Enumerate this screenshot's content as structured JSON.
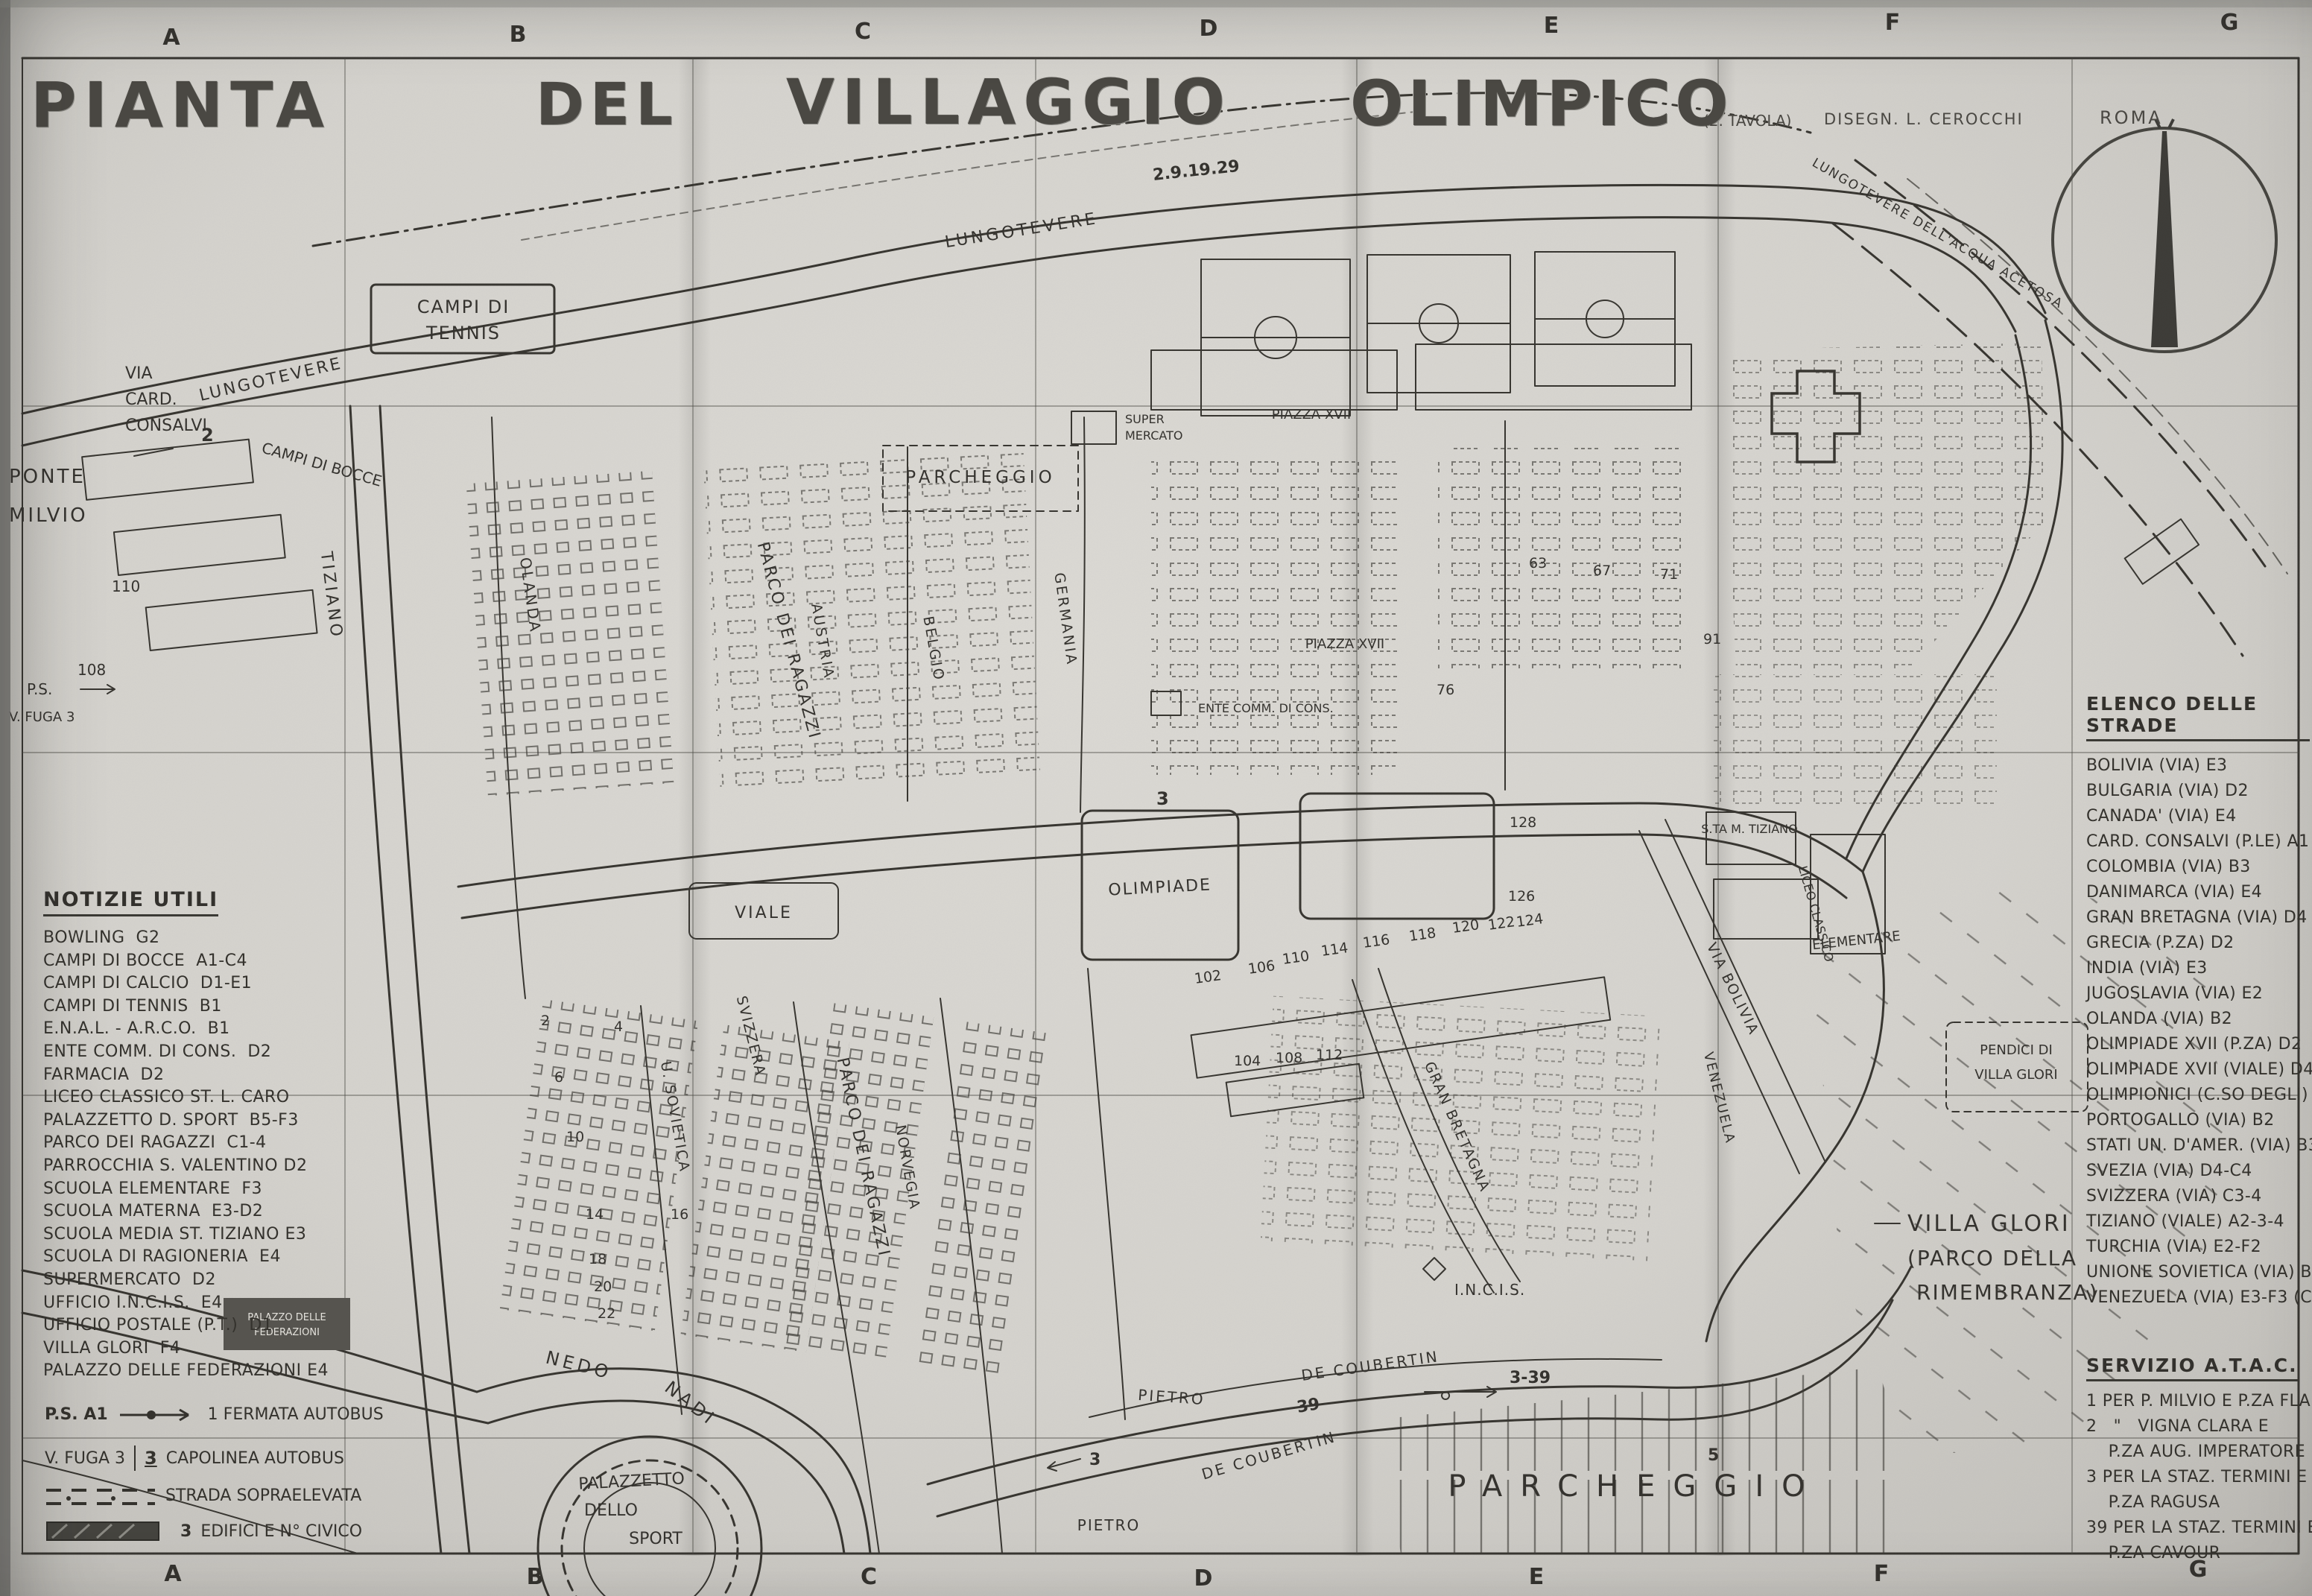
{
  "title": {
    "pianta": "PIANTA",
    "del": "DEL",
    "villaggio": "VILLAGGIO",
    "olimpico": "OLIMPICO",
    "note": "(2. TAVOLA)",
    "credit": "DISEGN. L. CEROCCHI",
    "city": "ROMA"
  },
  "grid": {
    "top": [
      "A",
      "B",
      "C",
      "D",
      "E",
      "F",
      "G"
    ],
    "bottom": [
      "A",
      "B",
      "C",
      "D",
      "E",
      "F",
      "G"
    ]
  },
  "notizie": {
    "heading": "NOTIZIE UTILI",
    "items": [
      "BOWLING  G2",
      "CAMPI DI BOCCE  A1-C4",
      "CAMPI DI CALCIO  D1-E1",
      "CAMPI DI TENNIS  B1",
      "E.N.A.L. - A.R.C.O.  B1",
      "ENTE COMM. DI CONS.  D2",
      "FARMACIA  D2",
      "LICEO CLASSICO ST. L. CARO",
      "PALAZZETTO D. SPORT  B5-F3",
      "PARCO DEI RAGAZZI  C1-4",
      "PARROCCHIA S. VALENTINO D2",
      "SCUOLA ELEMENTARE  F3",
      "SCUOLA MATERNA  E3-D2",
      "SCUOLA MEDIA ST. TIZIANO E3",
      "SCUOLA DI RAGIONERIA  E4",
      "SUPERMERCATO  D2",
      "UFFICIO I.N.C.I.S.  E4",
      "UFFICIO POSTALE (P.T.)  D1",
      "VILLA GLORI  F4",
      "PALAZZO DELLE FEDERAZIONI E4"
    ]
  },
  "legend": {
    "ps": "P.S.",
    "ps_ref": "A1",
    "fermata": "1 FERMATA AUTOBUS",
    "vfuga": "V. FUGA 3",
    "capolinea_num": "3",
    "capolinea": "CAPOLINEA AUTOBUS",
    "strada": "STRADA SOPRAELEVATA",
    "edifici_num": "3",
    "edifici": "EDIFICI E N° CIVICO"
  },
  "elenco": {
    "heading": "ELENCO DELLE STRADE",
    "items": [
      "BOLIVIA (VIA) E3",
      "BULGARIA (VIA) D2",
      "CANADA' (VIA) E4",
      "CARD. CONSALVI (P.LE) A1",
      "COLOMBIA (VIA) B3",
      "DANIMARCA (VIA) E4",
      "GRAN BRETAGNA (VIA) D4",
      "GRECIA (P.ZA) D2",
      "INDIA (VIA) E3",
      "JUGOSLAVIA (VIA) E2",
      "OLANDA (VIA) B2",
      "OLIMPIADE XVII (P.ZA) D2",
      "OLIMPIADE XVII (VIALE) D4",
      "OLIMPIONICI (C.SO DEGLI) B1-F1",
      "PORTOGALLO (VIA) B2",
      "STATI UN. D'AMER. (VIA) B3-4",
      "SVEZIA (VIA) D4-C4",
      "SVIZZERA (VIA) C3-4",
      "TIZIANO (VIALE) A2-3-4",
      "TURCHIA (VIA) E2-F2",
      "UNIONE SOVIETICA (VIA) B3-4",
      "VENEZUELA (VIA) E3-F3 (C3)"
    ]
  },
  "atac": {
    "heading": "SERVIZIO A.T.A.C.",
    "lines": [
      "1 PER P. MILVIO E P.ZA FLAM.",
      "2   \"   VIGNA CLARA E",
      "    P.ZA AUG. IMPERATORE",
      "3 PER LA STAZ. TERMINI E",
      "    P.ZA RAGUSA",
      "39 PER LA STAZ. TERMINI E",
      "    P.ZA CAVOUR"
    ]
  },
  "map_labels": {
    "ponte1": "PONTE",
    "ponte2": "MILVIO",
    "card1": "VIA",
    "card2": "CARD.",
    "card3": "CONSALVI",
    "lungo1": "LUNGOTEVERE",
    "lungo2": "LUNGOTEVERE",
    "lungo3": "LUNGOTEVERE DELL'ACQUA ACETOSA",
    "tennis1": "CAMPI DI",
    "tennis2": "TENNIS",
    "bocce": "CAMPI DI BOCCE",
    "parch_top": "PARCHEGGIO",
    "pza1": "PIAZZA XVII",
    "pza2": "PIAZZA XVII",
    "super1": "SUPER",
    "super2": "MERCATO",
    "ente": "ENTE COMM. DI CONS.",
    "tiziano": "TIZIANO",
    "olanda": "OLANDA",
    "sovietica": "U. SOVIETICA",
    "austria": "AUSTRIA",
    "belgio": "BELGIO",
    "germania": "GERMANIA",
    "ragazzi1": "PARCO DEI RAGAZZI",
    "ragazzi2": "PARCO DEI RAGAZZI",
    "norvegia": "NORVEGIA",
    "svizzera": "SVIZZERA",
    "granbret": "GRAN BRETAGNA",
    "bolivia": "VIA BOLIVIA",
    "venezuela": "VENEZUELA",
    "liceo": "LICEO CLASSICO",
    "stamaria": "S.TA M. TIZIANO",
    "elementare": "ELEMENTARE",
    "pendici1": "PENDICI DI",
    "pendici2": "VILLA GLORI",
    "vglori1": "VILLA GLORI",
    "vglori2": "(PARCO DELLA",
    "vglori3": "RIMEMBRANZA)",
    "nedo": "NEDO",
    "nadi": "NADI",
    "pietro1": "PIETRO",
    "decoub1": "DE COUBERTIN",
    "decoub2": "DE COUBERTIN",
    "pietro2": "PIETRO",
    "parch_bot": "PARCHEGGIO",
    "incis": "I.N.C.I.S.",
    "palaz1": "PALAZZETTO",
    "palaz2": "DELLO",
    "palaz3": "SPORT",
    "palfed1": "PALAZZO DELLE",
    "palfed2": "FEDERAZIONI",
    "olimpiade": "OLIMPIADE",
    "viale": "VIALE",
    "ps_top": "P.S.",
    "vfuga_top": "V. FUGA 3"
  },
  "bus": {
    "two": "2",
    "three": "3",
    "three_b": "3",
    "thirtynine": "39",
    "threethirtynine": "3-39",
    "five": "5",
    "topline": "2.9.19.29"
  },
  "numbers": [
    "110",
    "108",
    "2",
    "4",
    "6",
    "10",
    "14",
    "16",
    "18",
    "20",
    "22",
    "102",
    "106",
    "110",
    "114",
    "116",
    "118",
    "120",
    "122",
    "124",
    "126",
    "128",
    "104",
    "108",
    "112",
    "63",
    "67",
    "71",
    "91",
    "76"
  ],
  "colors": {
    "paper": "#d8d6d1",
    "ink": "#36342f"
  }
}
